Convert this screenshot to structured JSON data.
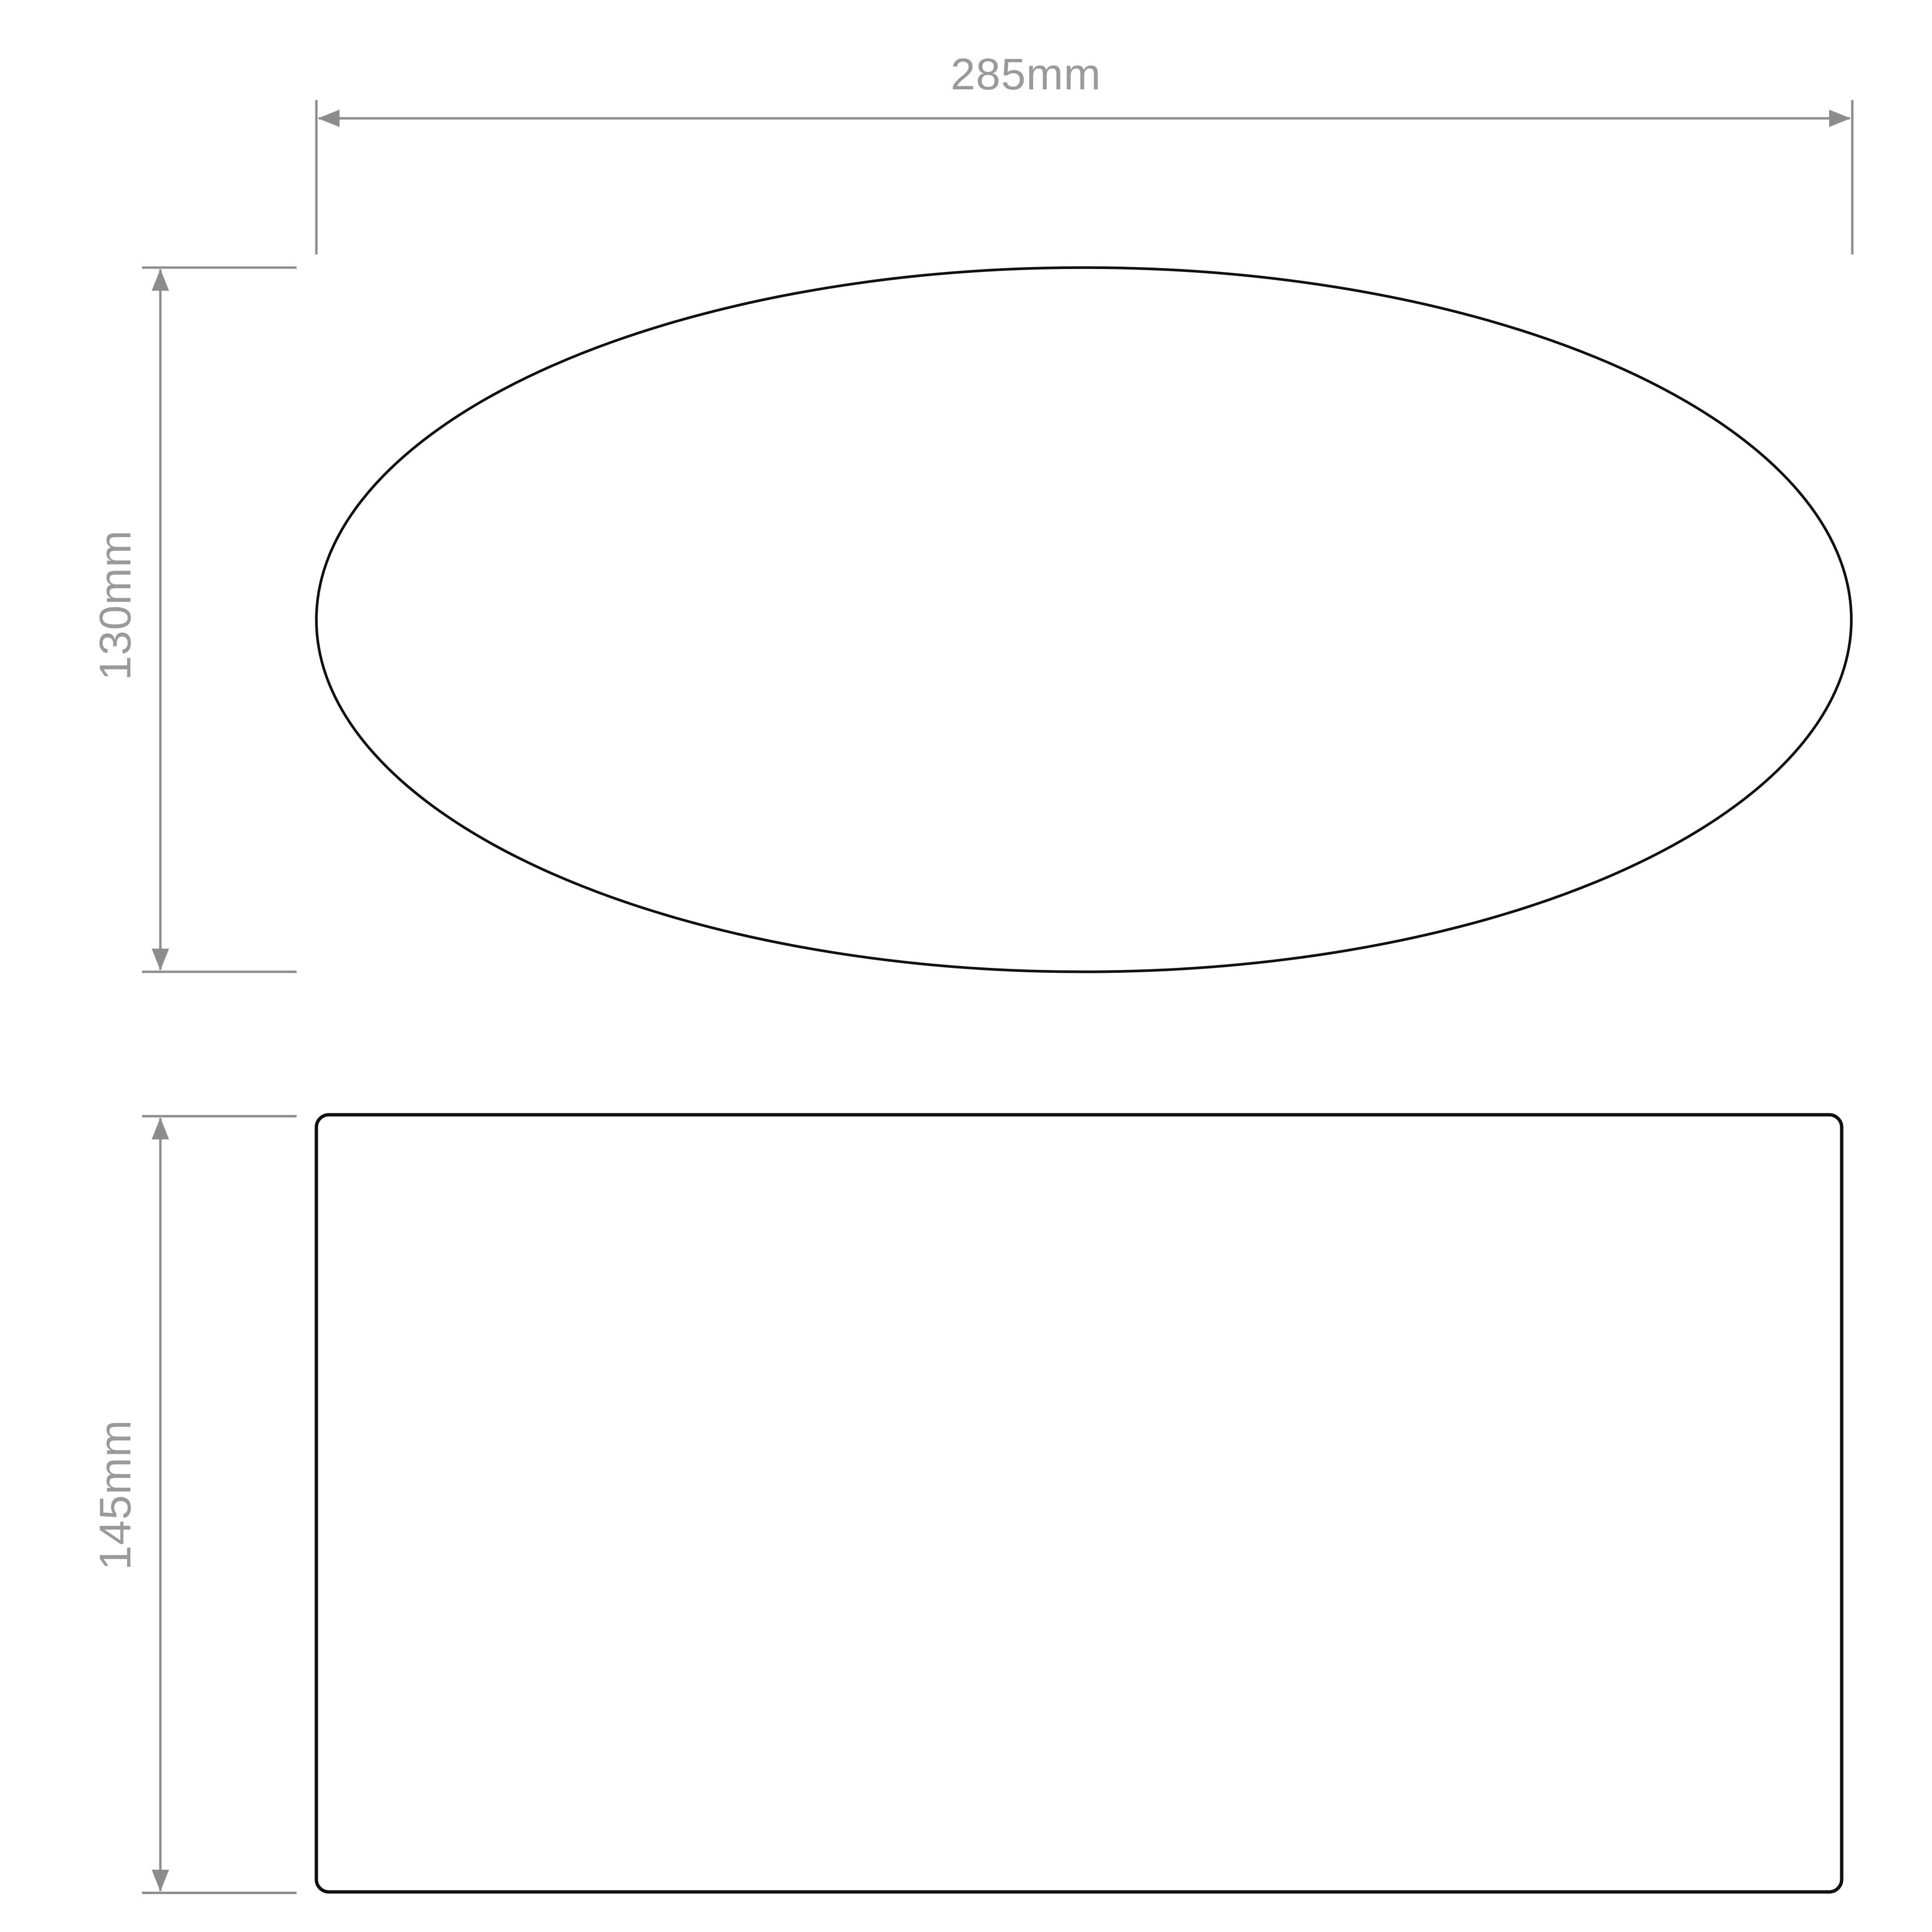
{
  "drawing": {
    "type": "technical-dimension-drawing",
    "views": {
      "top_view_shape": "ellipse",
      "front_view_shape": "rounded-rectangle"
    },
    "dimensions": {
      "width_label": "285mm",
      "top_view_height_label": "130mm",
      "front_view_height_label": "145mm"
    },
    "colors": {
      "background": "#ffffff",
      "outline": "#111111",
      "dimension_line": "#8d8d8d",
      "arrow": "#8d8d8d",
      "label_text": "#9a9a9a"
    }
  }
}
